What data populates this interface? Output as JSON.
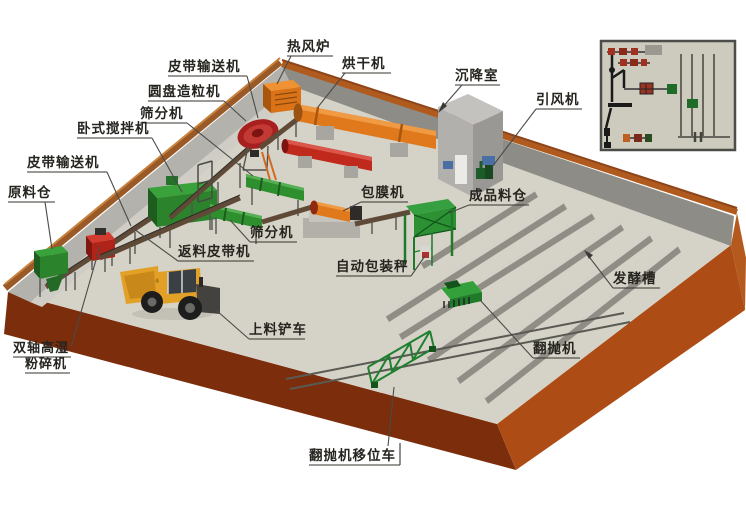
{
  "scene": {
    "title": "有机肥生产线设备布局三维示意图",
    "background": "#ffffff"
  },
  "palette": {
    "floor": "#d5d3c7",
    "base_left_side": "#7b2d0c",
    "base_right_side": "#ad4c15",
    "wall_left_face": "#b4b2ac",
    "wall_right_face": "#8e8c86",
    "wall_rim_left": "#9a5a28",
    "wall_rim_right": "#b05a1e",
    "trough_ridge": "#d4d2c8",
    "trough_face": "#8f8d85",
    "machine_green": "#2e8f2e",
    "machine_orange": "#e0791c",
    "machine_red": "#c02a1c",
    "loader_yellow": "#e2a026",
    "label_ink": "#26241f"
  },
  "labels": {
    "belt_conveyor_top": "皮带输送机",
    "hot_air_furnace": "热风炉",
    "dryer": "烘干机",
    "disc_granulator": "圆盘造粒机",
    "screener_top": "筛分机",
    "horizontal_mixer": "卧式搅拌机",
    "belt_conveyor_left": "皮带输送机",
    "raw_material_bin": "原料仓",
    "settling_chamber": "沉降室",
    "induced_draft_fan": "引风机",
    "coating_machine": "包膜机",
    "finished_product_bin": "成品料仓",
    "screener_mid": "筛分机",
    "return_belt_conveyor": "返料皮带机",
    "auto_packing_scale": "自动包装秤",
    "fermentation_trough": "发酵槽",
    "loading_forklift": "上料铲车",
    "crusher_line1": "双轴高湿",
    "crusher_line2": "粉碎机",
    "compost_turner": "翻抛机",
    "turner_shifting_vehicle": "翻抛机移位车"
  }
}
